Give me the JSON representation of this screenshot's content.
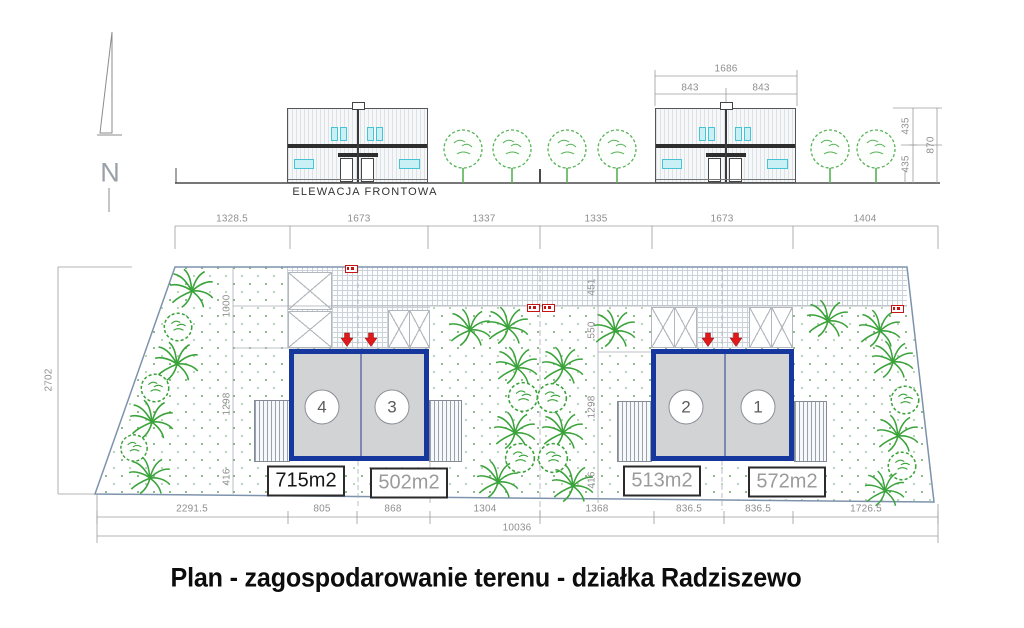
{
  "title": "Plan - zagospodarowanie terenu - działka Radziszewo",
  "north_label": "N",
  "elevation": {
    "label": "ELEWACJA FRONTOWA",
    "dims": {
      "total_width": "1686",
      "halves": [
        "843",
        "843"
      ],
      "heights": [
        "435",
        "435"
      ],
      "total_height": "870"
    }
  },
  "site_plan": {
    "dims_top": [
      "1328.5",
      "1673",
      "1337",
      "1335",
      "1673",
      "1404"
    ],
    "dims_bottom": [
      "2291.5",
      "805",
      "868",
      "1304",
      "1368",
      "836.5",
      "836.5",
      "1726.5"
    ],
    "dims_bottom_total": "10036",
    "dim_left_height": "2702",
    "dims_inner_left": [
      "1000",
      "1298",
      "416"
    ],
    "dims_inner_right": [
      "451",
      "550",
      "1298",
      "416"
    ],
    "buildings": [
      {
        "units": [
          {
            "number": "4",
            "area": "715m2"
          },
          {
            "number": "3",
            "area": "502m2"
          }
        ]
      },
      {
        "units": [
          {
            "number": "2",
            "area": "513m2"
          },
          {
            "number": "1",
            "area": "572m2"
          }
        ]
      }
    ]
  },
  "colors": {
    "building_border_blue": "#16379e",
    "building_fill_gray": "#d2d3d5",
    "arrow_red": "#e01a1a",
    "tree_green": "#3aa33a",
    "boundary_blue": "#7d93ab",
    "dim_gray": "#8f8f8f",
    "window_cyan": "#c9f0f4"
  }
}
